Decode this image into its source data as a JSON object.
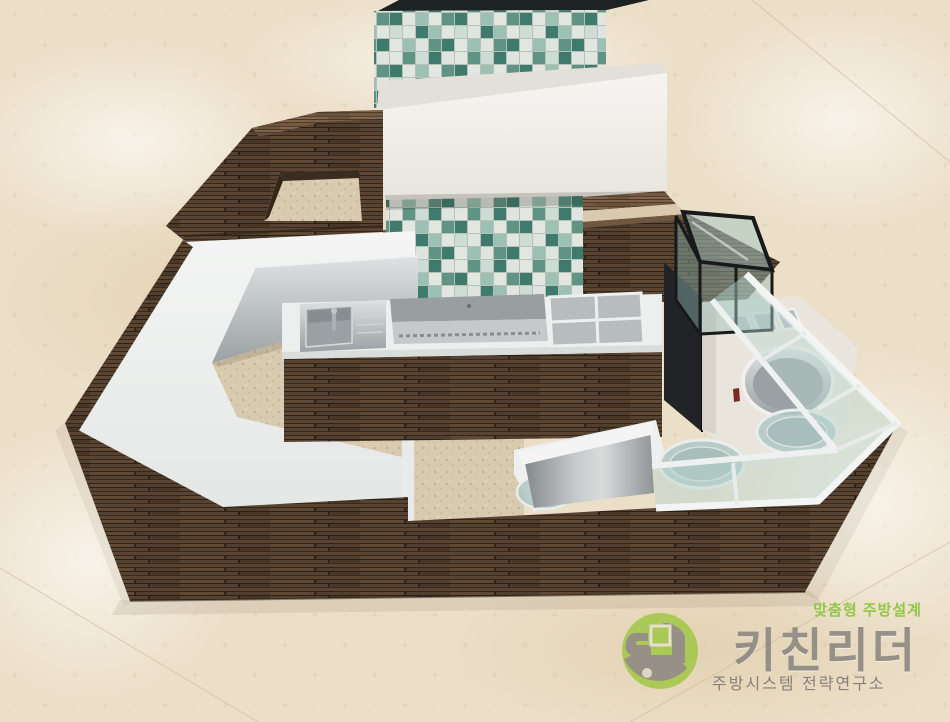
{
  "scene": {
    "description": "3D interior rendering of an octagonal cafe kiosk: dark wood panelled counters with white countertops, a teal mosaic-tile cooking wall with white exhaust hood, stainless sink / griddle / bain-marie island, black-framed glass showcase, round-well cabinet and a white-framed glass display band, all on a beige marble floor"
  },
  "watermark": {
    "tagline": "맞춤형 주방설계",
    "brand": "키친리더",
    "subtitle": "주방시스템 전략연구소"
  },
  "palette": {
    "floor_marble": "#ecdfc8",
    "interior_floor": "#d7caae",
    "wood_dark": "#4c392a",
    "wood_light": "#6e563f",
    "counter_white": "#eef0ef",
    "mosaic_white": "#e2e6e1",
    "mosaic_mint": "#9cc0b3",
    "mosaic_teal_mid": "#5f9485",
    "mosaic_teal_dark": "#3f7b6d",
    "stainless": "#9aa1a4",
    "glass_teal": "#b7d4ce",
    "hood_white": "#f1efe9",
    "showcase_frame": "#17191a",
    "black_cap": "#1d2223",
    "logo_green": "#8ec641",
    "logo_icon_green": "#a6c84e",
    "logo_gray": "#8f8a83"
  }
}
